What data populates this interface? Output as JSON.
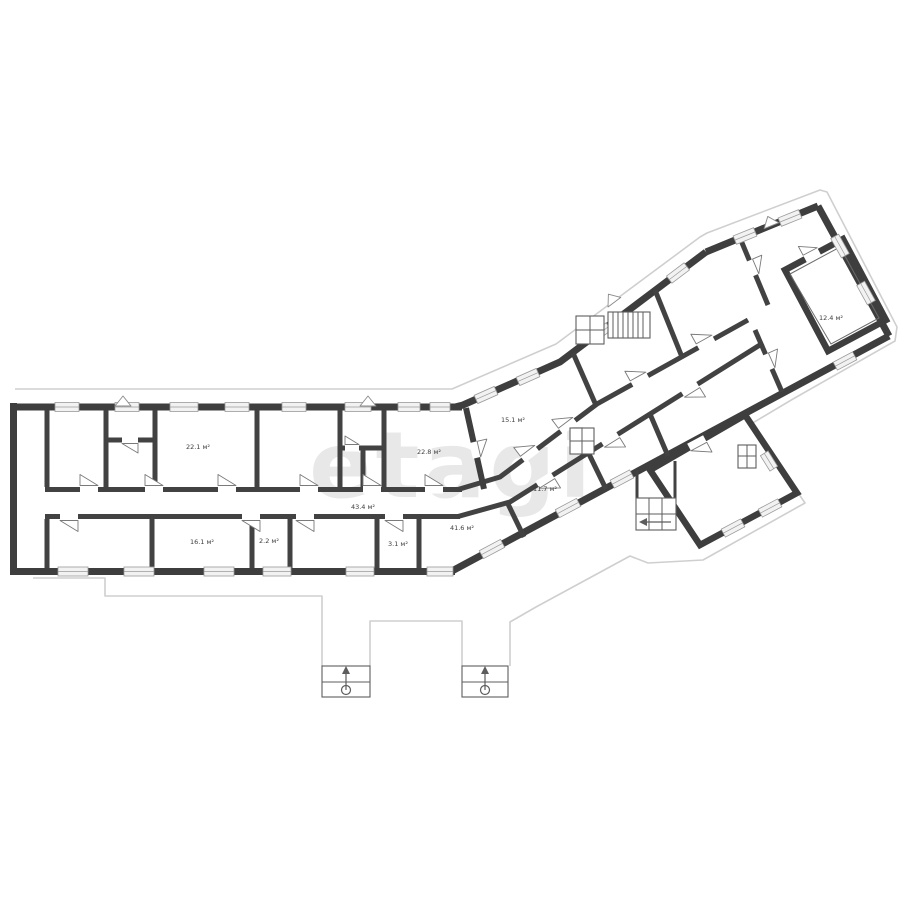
{
  "watermark": "etagi",
  "rooms": [
    {
      "name": "upper-room-1",
      "area": "22.1 м²"
    },
    {
      "name": "upper-room-2",
      "area": "22.8 м²"
    },
    {
      "name": "corridor",
      "area": "43.4 м²"
    },
    {
      "name": "lower-room-1",
      "area": "16.1 м²"
    },
    {
      "name": "lower-room-2",
      "area": "2.2 м²"
    },
    {
      "name": "lower-room-3",
      "area": "3.1 м²"
    },
    {
      "name": "hall",
      "area": "41.6 м²"
    },
    {
      "name": "wing-room-1",
      "area": "15.1 м²"
    },
    {
      "name": "wing-room-2",
      "area": "11.7 м²"
    },
    {
      "name": "block-room",
      "area": "12.4 м²"
    }
  ],
  "colors": {
    "wall": "#3e3e3e",
    "outline": "#cfcfcf",
    "watermark": "#e8e8e8",
    "label": "#3c3c3c"
  }
}
